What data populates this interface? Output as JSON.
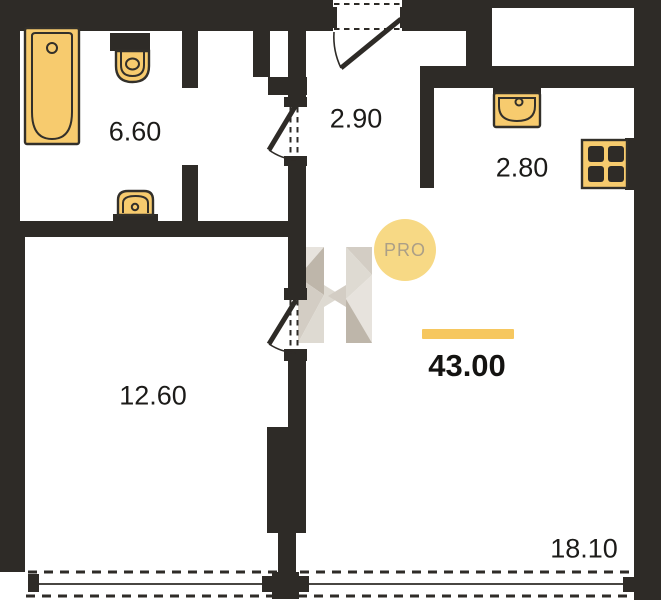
{
  "plan": {
    "title": "apartment-floor-plan",
    "total_area": {
      "value": "43.00",
      "unit": "m2"
    },
    "rooms": {
      "bathroom": {
        "name": "bathroom",
        "area": "6.60"
      },
      "hallway": {
        "name": "hallway",
        "area": "2.90"
      },
      "kitchen": {
        "name": "kitchen",
        "area": "2.80"
      },
      "bedroom": {
        "name": "bedroom",
        "area": "12.60"
      },
      "living_room": {
        "name": "living-room",
        "area": "18.10"
      }
    },
    "watermark": {
      "badge": "PRO",
      "logo": "H"
    },
    "fixtures": {
      "bathtub": "bathtub-icon",
      "toilet": "toilet-icon",
      "bathroom_sink": "sink-icon",
      "kitchen_sink": "kitchen-sink-icon",
      "stove": "stove-icon"
    },
    "doors": [
      "entrance-door",
      "bathroom-door",
      "bedroom-door"
    ],
    "windows": [
      "bedroom-window",
      "living-room-window"
    ],
    "colors": {
      "wall": "#2e2b27",
      "fixture_fill": "#f7cb6e",
      "fixture_outline": "#33302a",
      "accent_bar": "#f6c75f",
      "badge_fill": "#f7d985",
      "badge_text": "#ab9f87",
      "label_text": "#1c1b19"
    }
  }
}
